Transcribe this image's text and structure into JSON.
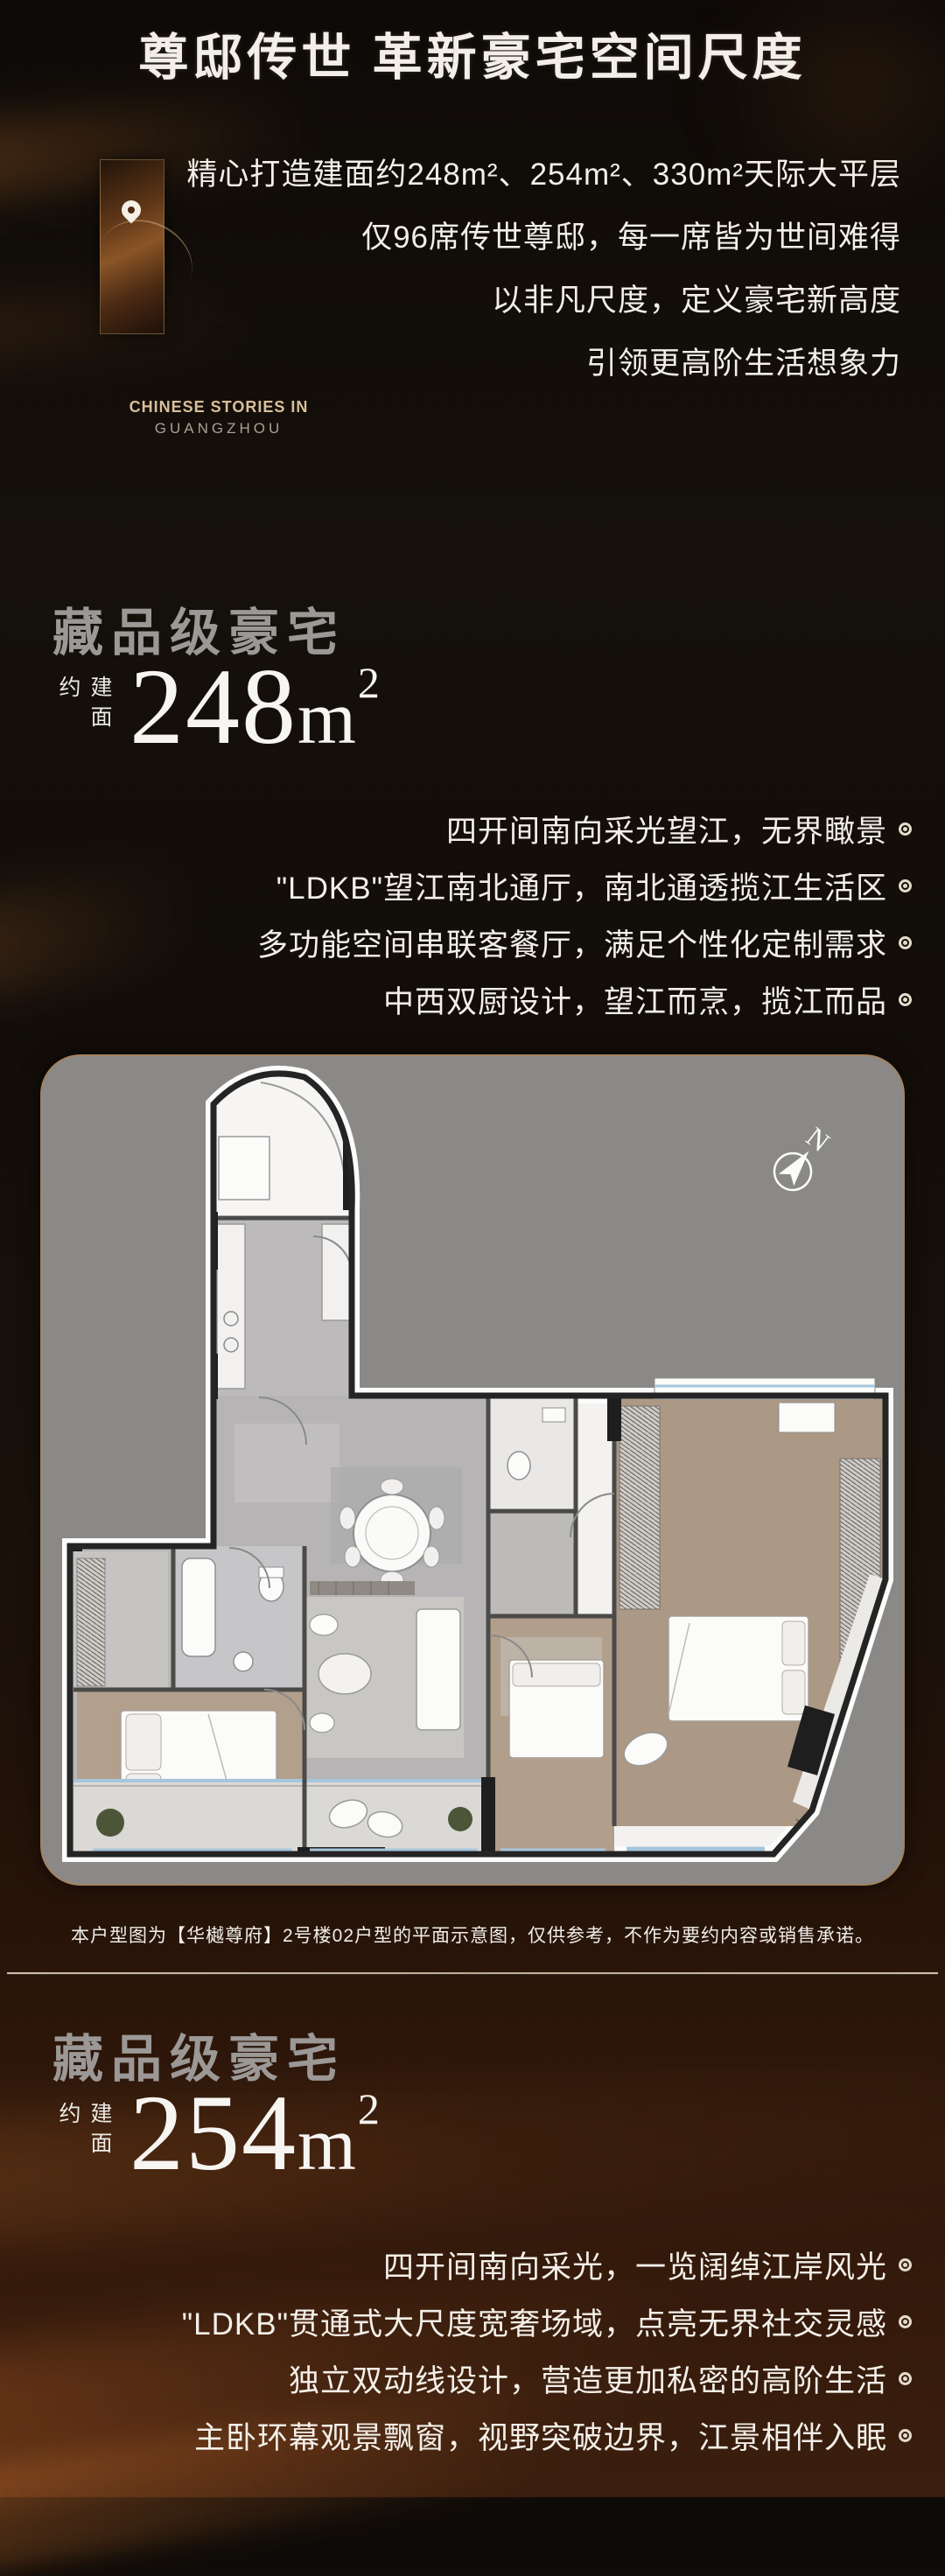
{
  "header": {
    "title": "尊邸传世 革新豪宅空间尺度"
  },
  "logo": {
    "line1": "CHINESE STORIES IN",
    "line2": "GUANGZHOU"
  },
  "intro": {
    "lines": [
      "精心打造建面约248m²、254m²、330m²天际大平层",
      "仅96席传世尊邸，每一席皆为世间难得",
      "以非凡尺度，定义豪宅新高度",
      "引领更高阶生活想象力"
    ]
  },
  "section_248": {
    "heading": "藏品级豪宅",
    "area_label": "建面约",
    "area_number": "248",
    "area_unit": "m",
    "area_sup": "2",
    "bullets": [
      "四开间南向采光望江，无界瞰景",
      "\"LDKB\"望江南北通厅，南北通透揽江生活区",
      "多功能空间串联客餐厅，满足个性化定制需求",
      "中西双厨设计，望江而烹，揽江而品"
    ]
  },
  "floorplan": {
    "compass_n": "N",
    "caption": "本户型图为【华樾尊府】2号楼02户型的平面示意图，仅供参考，不作为要约内容或销售承诺。"
  },
  "section_254": {
    "heading": "藏品级豪宅",
    "area_label": "建面约",
    "area_number": "254",
    "area_unit": "m",
    "area_sup": "2",
    "bullets": [
      "四开间南向采光，一览阔绰江岸风光",
      "\"LDKB\"贯通式大尺度宽奢场域，点亮无界社交灵感",
      "独立双动线设计，营造更加私密的高阶生活",
      "主卧环幕观景飘窗，视野突破边界，江景相伴入眠"
    ]
  },
  "colors": {
    "accent_tan": "#d9bf9b",
    "heading_gray": "#9b9896",
    "text_white": "#f3efe8",
    "card_gray": "#8b8987",
    "card_border": "#aa8252",
    "window_blue": "#a5c6dd",
    "wood": "#b29f8c",
    "marble": "#b8b6b6"
  }
}
